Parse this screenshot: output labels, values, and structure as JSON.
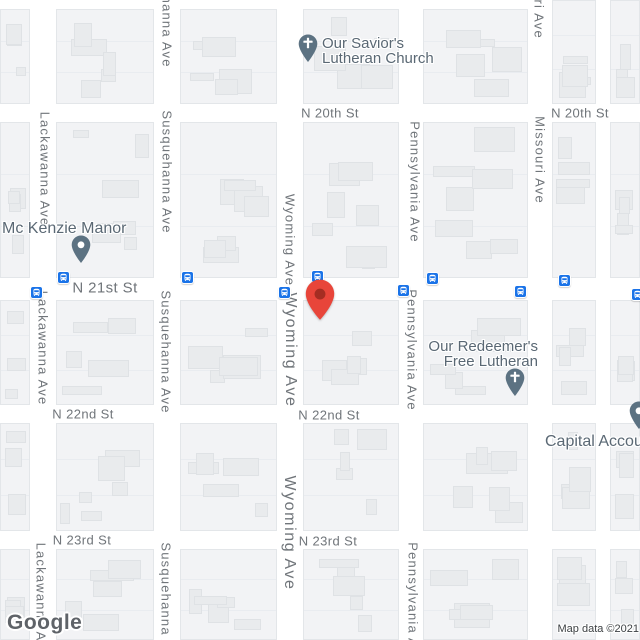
{
  "map": {
    "provider_logo": "Google",
    "attribution": "Map data ©2021",
    "colors": {
      "marker_red": "#E8453A",
      "marker_red_inner": "#A42D22",
      "transit_blue": "#1A73E8",
      "poi_pin_slate": "#5C7282",
      "street_label_gray": "#70757A",
      "poi_label_slate": "#5A6874",
      "road_white": "#FFFFFF",
      "block_fill": "#F2F3F5"
    },
    "street_labels": [
      {
        "text": "N 20th St",
        "x": 330,
        "y": 113
      },
      {
        "text": "N 20th St",
        "x": 580,
        "y": 113
      },
      {
        "text": "N 21st St",
        "x": 105,
        "y": 288,
        "size": "lg"
      },
      {
        "text": "N 22nd St",
        "x": 83,
        "y": 414
      },
      {
        "text": "N 22nd St",
        "x": 329,
        "y": 415
      },
      {
        "text": "N 23rd St",
        "x": 82,
        "y": 540
      },
      {
        "text": "N 23rd St",
        "x": 328,
        "y": 541
      }
    ],
    "avenue_labels": [
      {
        "text": "Susquehanna Ave",
        "x": 167,
        "y": 6
      },
      {
        "text": "Missouri Ave",
        "x": 539,
        "y": -5
      },
      {
        "text": "Lackawanna Ave",
        "x": 45,
        "y": 169
      },
      {
        "text": "Susquehanna Ave",
        "x": 167,
        "y": 172
      },
      {
        "text": "Wyoming Ave",
        "x": 290,
        "y": 240
      },
      {
        "text": "Pennsylvania Ave",
        "x": 415,
        "y": 182
      },
      {
        "text": "Missouri Ave",
        "x": 540,
        "y": 160
      },
      {
        "text": "Lackawanna Ave",
        "x": 43,
        "y": 348
      },
      {
        "text": "Susquehanna Ave",
        "x": 166,
        "y": 352
      },
      {
        "text": "Wyoming Ave",
        "x": 290,
        "y": 350,
        "size": "lg"
      },
      {
        "text": "Pennsylvania Ave",
        "x": 412,
        "y": 350
      },
      {
        "text": "Wyoming Ave",
        "x": 289,
        "y": 533,
        "size": "lg"
      },
      {
        "text": "Lackawanna Ave",
        "x": 41,
        "y": 600
      },
      {
        "text": "Susquehanna Ave",
        "x": 166,
        "y": 604
      },
      {
        "text": "Pennsylvania Ave",
        "x": 413,
        "y": 603
      }
    ],
    "pois": [
      {
        "name": "Our Savior's Lutheran Church",
        "lines": [
          "Our Savior's",
          "Lutheran Church"
        ],
        "align": "left",
        "x": 322,
        "y": 36,
        "font": 15,
        "pin": {
          "type": "church",
          "x": 308,
          "y": 63
        }
      },
      {
        "name": "Mc Kenzie Manor",
        "lines": [
          "Mc Kenzie Manor"
        ],
        "align": "left",
        "x": 2,
        "y": 221,
        "font": 16,
        "pin": {
          "type": "dot",
          "x": 81,
          "y": 264
        }
      },
      {
        "name": "Our Redeemer's Free Lutheran",
        "lines": [
          "Our Redeemer's",
          "Free Lutheran"
        ],
        "align": "right",
        "x": 538,
        "y": 339,
        "font": 15,
        "pin": {
          "type": "church",
          "x": 515,
          "y": 397
        }
      },
      {
        "name": "Capital Account",
        "lines": [
          "Capital Account"
        ],
        "align": "left",
        "x": 545,
        "y": 434,
        "font": 16,
        "pin": {
          "type": "dot",
          "x": 639,
          "y": 430
        }
      }
    ],
    "bus_stops": [
      {
        "x": 36,
        "y": 292
      },
      {
        "x": 63,
        "y": 277
      },
      {
        "x": 187,
        "y": 277
      },
      {
        "x": 284,
        "y": 292
      },
      {
        "x": 317,
        "y": 276
      },
      {
        "x": 403,
        "y": 290
      },
      {
        "x": 432,
        "y": 278
      },
      {
        "x": 520,
        "y": 291
      },
      {
        "x": 564,
        "y": 280
      },
      {
        "x": 637,
        "y": 294
      }
    ],
    "destination_marker": {
      "x": 320,
      "y": 320
    }
  }
}
